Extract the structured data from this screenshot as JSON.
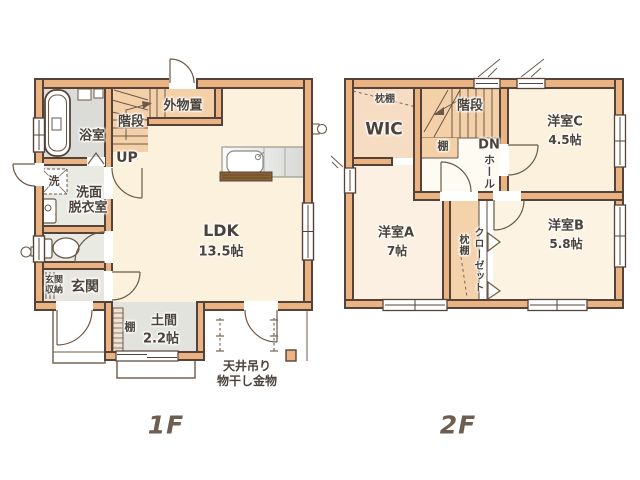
{
  "floor1": {
    "label": "1F",
    "bath": "浴室",
    "stairs": "階段",
    "outdoor_storage": "外物置",
    "up": "UP",
    "washer": "洗",
    "washroom": [
      "洗面",
      "脱衣室"
    ],
    "entrance_storage": [
      "玄関",
      "収納"
    ],
    "entrance": "玄関",
    "shelf": "棚",
    "doma": "土間",
    "doma_size": "2.2帖",
    "ldk": "LDK",
    "ldk_size": "13.5帖",
    "laundry_hw": [
      "天井吊り",
      "物干し金物"
    ]
  },
  "floor2": {
    "label": "2F",
    "pillow_shelf": "枕棚",
    "wic": "WIC",
    "stairs": "階段",
    "shelf": "棚",
    "down": "DN",
    "hall": "ホール",
    "room_c": "洋室C",
    "room_c_size": "4.5帖",
    "room_a": "洋室A",
    "room_a_size": "7帖",
    "room_b": "洋室B",
    "room_b_size": "5.8帖",
    "closet": "クローゼット",
    "closet_pillow_shelf": "枕棚"
  },
  "colors": {
    "wall_fill": "#ECB382",
    "wall_outline": "#54433A",
    "room_cream": "#FCF1DD",
    "room_peach": "#F6DCC3",
    "stairs_fill": "#F4D0A8",
    "wet_area_gray": "#E9EAE2",
    "doma_gray": "#E3E3DD",
    "label_text": "#4A423B",
    "floor_label_text": "#6E5E50"
  }
}
